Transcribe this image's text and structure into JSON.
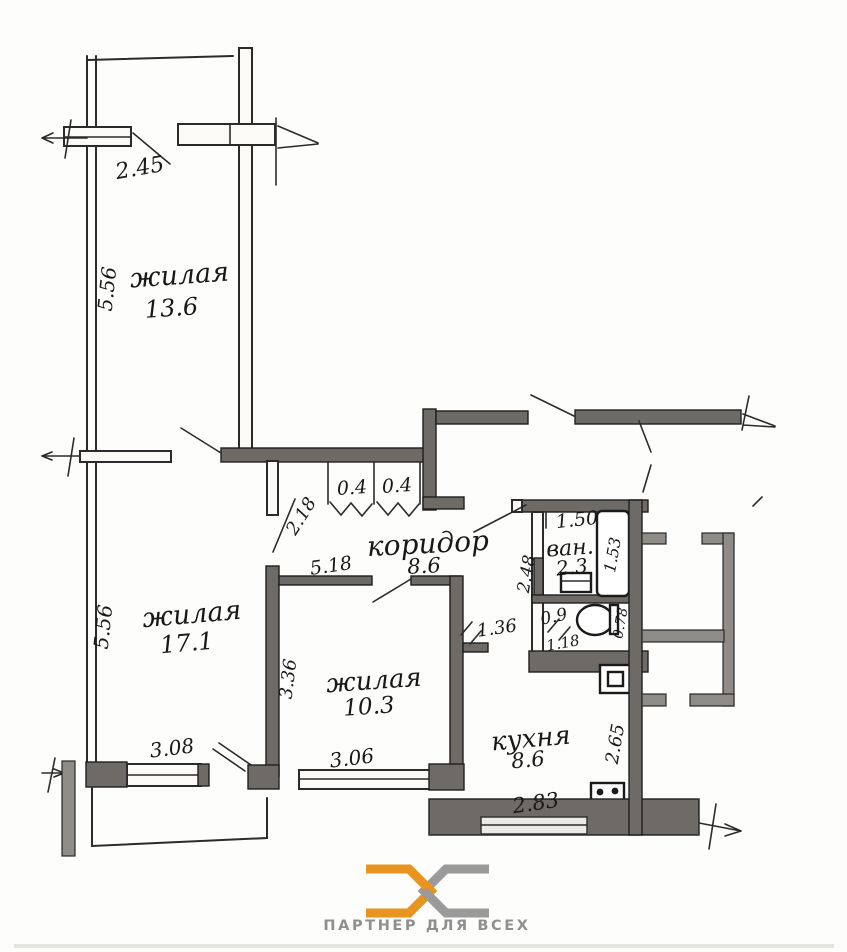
{
  "plan": {
    "rooms": {
      "living_top": {
        "label": "жилая",
        "area": "13.6"
      },
      "living_left": {
        "label": "жилая",
        "area": "17.1"
      },
      "living_mid": {
        "label": "жилая",
        "area": "10.3"
      },
      "corridor": {
        "label": "коридор",
        "area": "8.6"
      },
      "bath": {
        "label": "ван.",
        "area": "2.3"
      },
      "kitchen": {
        "label": "кухня",
        "area": "8.6"
      }
    },
    "dims": {
      "balcony_width": "2.45",
      "living_top_depth": "5.56",
      "living_left_depth": "5.56",
      "living_left_width": "3.08",
      "door_living_left": "2.18",
      "corridor_length": "5.18",
      "closet_a": "0.4",
      "closet_b": "0.4",
      "bath_width": "1.50",
      "bath_length": "1.53",
      "bath_depth": "2.48",
      "wc_width": "0.9",
      "wc_length": "1.18",
      "wc_depth": "0.78",
      "kitchen_door": "1.36",
      "living_mid_depth": "3.36",
      "living_mid_width": "3.06",
      "kitchen_width": "2.83",
      "kitchen_depth": "2.65"
    }
  },
  "footer": {
    "logo_text": "ПАРТНЕР ДЛЯ ВСЕХ"
  },
  "colors": {
    "wall": "#6e6a66",
    "ink": "#2b2b2b",
    "logo_orange": "#E8941F",
    "logo_gray": "#9a9a9a"
  }
}
